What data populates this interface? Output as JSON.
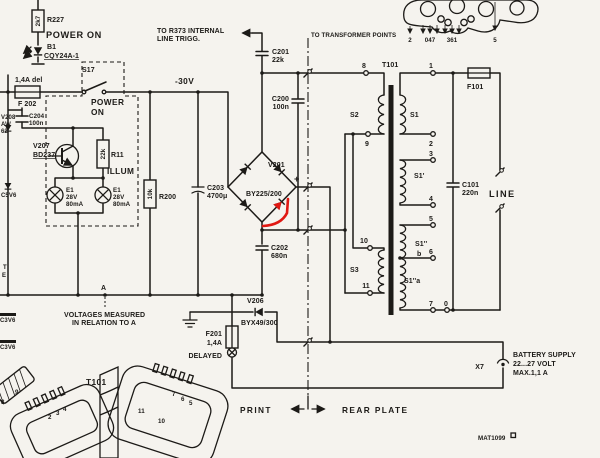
{
  "colors": {
    "background": "#f5f3ee",
    "ink": "#1c1a17",
    "highlight_red": "#e01812"
  },
  "notes": {
    "to_r373_1": "TO R373 INTERNAL",
    "to_r373_2": "LINE TRIGG.",
    "to_transformer": "TO TRANSFORMER POINTS",
    "rail_minus30": "-30V",
    "node_a": "A",
    "meas_1": "VOLTAGES MEASURED",
    "meas_2": "IN RELATION TO A",
    "print": "PRINT",
    "rear_plate": "REAR PLATE",
    "line": "LINE",
    "illum": "ILLUM",
    "power_on_led": "POWER ON",
    "power_on_sw1": "POWER",
    "power_on_sw2": "ON",
    "battery_1": "BATTERY SUPPLY",
    "battery_2": "22...27 VOLT",
    "battery_3": "MAX.1,1 A",
    "x7": "X7",
    "doc_no": "MAT1099"
  },
  "components": {
    "r227": {
      "ref": "R227",
      "value": "2k7"
    },
    "b1": {
      "ref": "B1",
      "type": "CQY24A-1"
    },
    "f202": {
      "rating": "1,4A del",
      "ref": "F 202"
    },
    "s17": {
      "ref": "S17"
    },
    "c204": {
      "ref": "C204",
      "value": "100n"
    },
    "v207": {
      "ref": "V207",
      "type": "BD237"
    },
    "r11": {
      "ref": "R11",
      "value": "22k"
    },
    "lamp_a": {
      "ref": "E1",
      "voltage": "28V",
      "current": "80mA"
    },
    "lamp_b": {
      "ref": "E1",
      "voltage": "28V",
      "current": "80mA"
    },
    "r200": {
      "ref": "R200",
      "value": "10k"
    },
    "c203": {
      "ref": "C203",
      "value": "4700μ"
    },
    "c201": {
      "ref": "C201",
      "value": "22k"
    },
    "c200": {
      "ref": "C200",
      "value": "100n"
    },
    "v201": {
      "ref": "V201",
      "type": "BY225/200",
      "polarity": "+"
    },
    "c202": {
      "ref": "C202",
      "value": "680n"
    },
    "v206": {
      "ref": "V206",
      "type": "BYX49/300"
    },
    "f201": {
      "ref": "F201",
      "rating": "1,4A",
      "note": "DELAYED"
    },
    "f101": {
      "ref": "F101"
    },
    "c101": {
      "ref": "C101",
      "value": "220n"
    }
  },
  "transformer": {
    "ref": "T101",
    "windings": {
      "s2": "S2",
      "s1": "S1",
      "s1p": "S1'",
      "s1pp": "S1''",
      "s1pp_b": "b",
      "s1pp_a": "S1''a",
      "s3": "S3"
    },
    "pins_left": [
      "8",
      "9",
      "10",
      "11"
    ],
    "pins_right": [
      "1",
      "2",
      "3",
      "4",
      "5",
      "6",
      "7",
      "0"
    ]
  },
  "connector": {
    "pins": [
      "2",
      "047",
      "361",
      "5"
    ]
  },
  "edge_fragments": {
    "v208": "V208",
    "aw": "AW",
    "n62": "62",
    "c5v6": "C5V6",
    "t": "T",
    "e": "E",
    "c3v6_top": "C3V6",
    "c3v6_bottom": "C3V6"
  },
  "t101_drawing": {
    "ref": "T101",
    "pins": [
      "9",
      "8",
      "2",
      "3",
      "4",
      "11",
      "10",
      "7",
      "6",
      "5"
    ]
  }
}
